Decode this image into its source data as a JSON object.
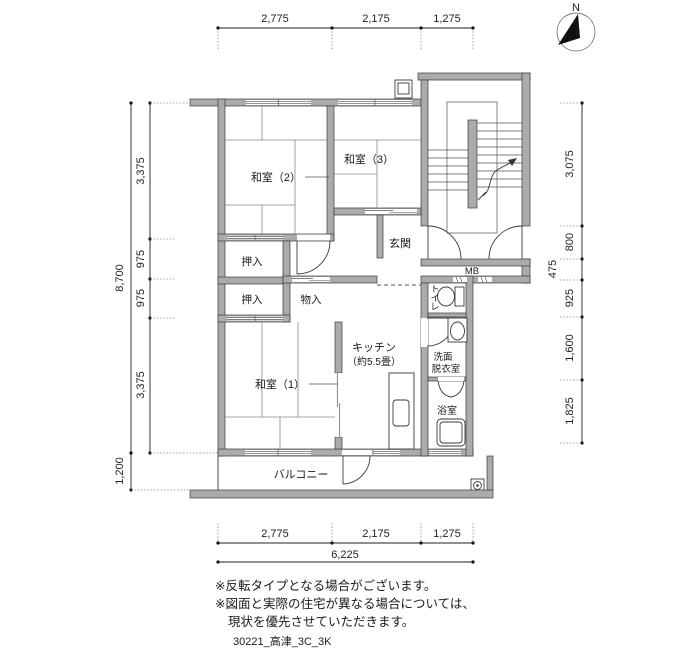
{
  "drawing": {
    "footer_code": "30221_高津_3C_3K",
    "notes": [
      "※反転タイプとなる場合がございます。",
      "※図面と実際の住宅が異なる場合については、",
      "現状を優先させていただきます。"
    ],
    "compass_label": "N",
    "colors": {
      "wall_fill": "#ababab",
      "line": "#3a3a3a"
    }
  },
  "rooms": {
    "washitsu2": "和室（2）",
    "washitsu3": "和室（3）",
    "washitsu1": "和室（1）",
    "oshiire_a": "押入",
    "oshiire_b": "押入",
    "mononyu": "物入",
    "genkan": "玄関",
    "kitchen_name": "キッチン",
    "kitchen_size": "（約5.5畳）",
    "toilet_chars": [
      "ト",
      "イ",
      "レ"
    ],
    "senmen": "洗面",
    "datsui": "脱衣室",
    "bath": "浴室",
    "balcony": "バルコニー",
    "meter_box": "MB"
  },
  "dims": {
    "top": [
      "2,775",
      "2,175",
      "1,275"
    ],
    "bottom": [
      "2,775",
      "2,175",
      "1,275"
    ],
    "bottom_total": "6,225",
    "left_segments": [
      "3,375",
      "975",
      "975",
      "3,375"
    ],
    "left_total": "8,700",
    "balcony_depth": "1,200",
    "right_segments": [
      "3,075",
      "800",
      "475",
      "925",
      "1,600",
      "1,825"
    ]
  }
}
